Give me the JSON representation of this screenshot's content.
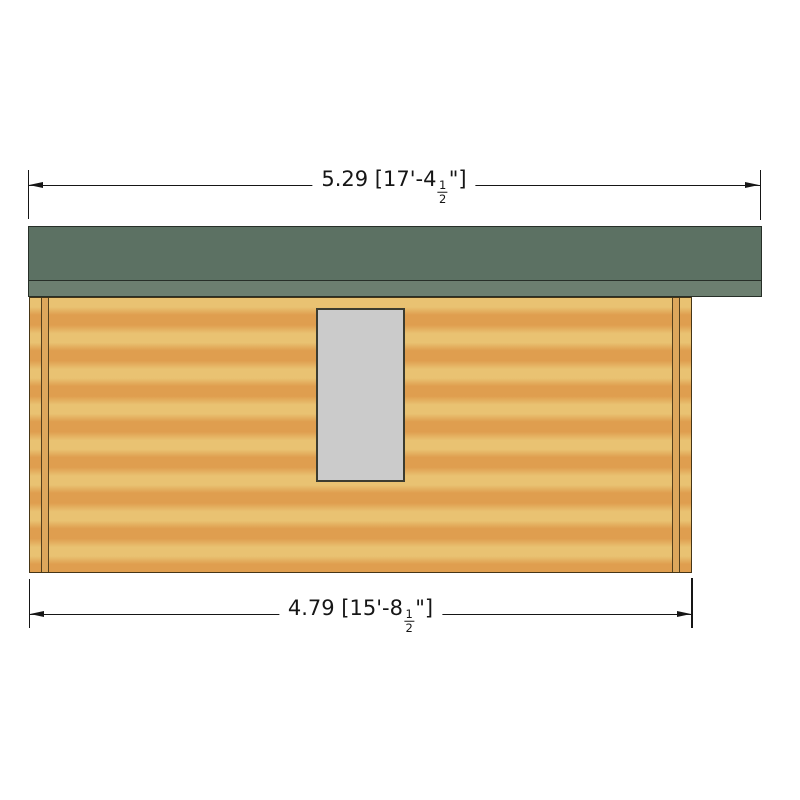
{
  "drawing": {
    "type": "log-cabin-side-elevation",
    "labels": {
      "top_dimension": {
        "prefix": "5.29 [17'-4",
        "frac_num": "1",
        "frac_den": "2",
        "suffix": "\"]"
      },
      "bottom_dimension": {
        "prefix": "4.79 [15'-8",
        "frac_num": "1",
        "frac_den": "2",
        "suffix": "\"]"
      }
    }
  },
  "colors": {
    "line_color": "#161616",
    "roof_main": "#5c7163",
    "roof_fascia": "#6c7f70",
    "wall_light": "#e9c272",
    "wall_dark": "#df9e4f",
    "corner_strip": "#dda75c",
    "window_fill": "#cbcbcb"
  }
}
